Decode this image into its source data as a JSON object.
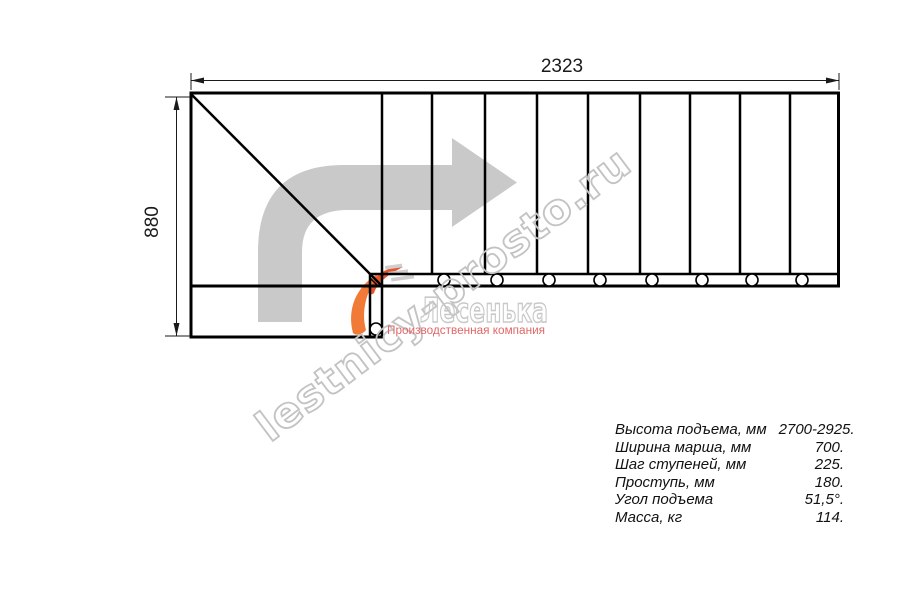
{
  "drawing": {
    "width_label": "2323",
    "height_label": "880",
    "type": "staircase-plan-view",
    "tread_count_straight_run": 9,
    "line_color": "#000000"
  },
  "direction_arrow": {
    "meaning": "ascend from bottom, turn right",
    "color": "#c9c9c9"
  },
  "watermark": {
    "site_text": "lestnicy-prosto.ru",
    "logo_text": "Лесенька",
    "tagline": "Производственная компания",
    "outline_color": "#c3c3c3",
    "tagline_color": "#e06767",
    "logo_accent_color": "#f07a36"
  },
  "specs": {
    "rows": [
      {
        "label": "Высота подъема, мм",
        "value": "2700-2925."
      },
      {
        "label": "Ширина марша, мм",
        "value": "700."
      },
      {
        "label": "Шаг ступеней, мм",
        "value": "225."
      },
      {
        "label": "Проступь, мм",
        "value": "180."
      },
      {
        "label": "Угол подъема",
        "value": "51,5°."
      },
      {
        "label": "Масса, кг",
        "value": "114."
      }
    ]
  }
}
